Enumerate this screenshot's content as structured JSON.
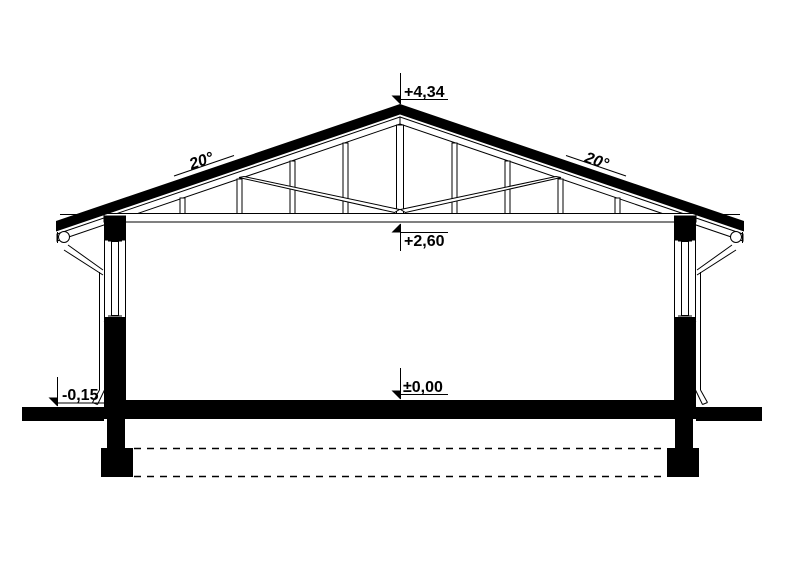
{
  "drawing": {
    "type_label": "building-cross-section",
    "levels": {
      "ridge": "+4,34",
      "ceiling": "+2,60",
      "floor": "±0,00",
      "exterior_ground": "-0,15"
    },
    "roof_pitch": {
      "left": "20°",
      "right": "20°"
    },
    "colors": {
      "ink": "#000000",
      "paper": "#ffffff"
    }
  }
}
